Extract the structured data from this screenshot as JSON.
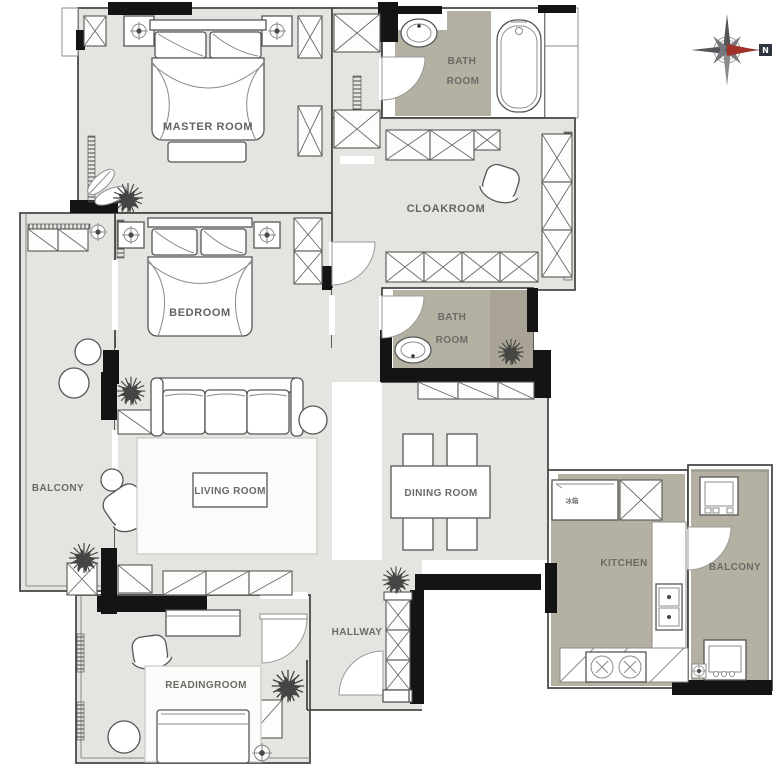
{
  "plan": {
    "rooms": {
      "master": {
        "label": "MASTER ROOM"
      },
      "bath_top": {
        "label_line1": "BATH",
        "label_line2": "ROOM"
      },
      "cloakroom": {
        "label": "CLOAKROOM"
      },
      "bedroom": {
        "label": "BEDROOM"
      },
      "balcony_left": {
        "label": "BALCONY"
      },
      "living": {
        "label": "LIVING ROOM"
      },
      "dining": {
        "label": "DINING ROOM"
      },
      "bath_mid": {
        "label_line1": "BATH",
        "label_line2": "ROOM"
      },
      "kitchen": {
        "label": "KITCHEN",
        "fridge_label": "冰箱"
      },
      "balcony_right": {
        "label": "BALCONY"
      },
      "reading": {
        "label": "READINGROOM"
      },
      "hallway": {
        "label": "HALLWAY"
      }
    },
    "compass": {
      "north_label": "N"
    },
    "colors": {
      "floor": "#e5e4e1",
      "wet": "#b5b1a2",
      "shower": "#a8a394",
      "wall": "#141414",
      "line": "#4a4a48",
      "accent": "#a03028"
    }
  }
}
